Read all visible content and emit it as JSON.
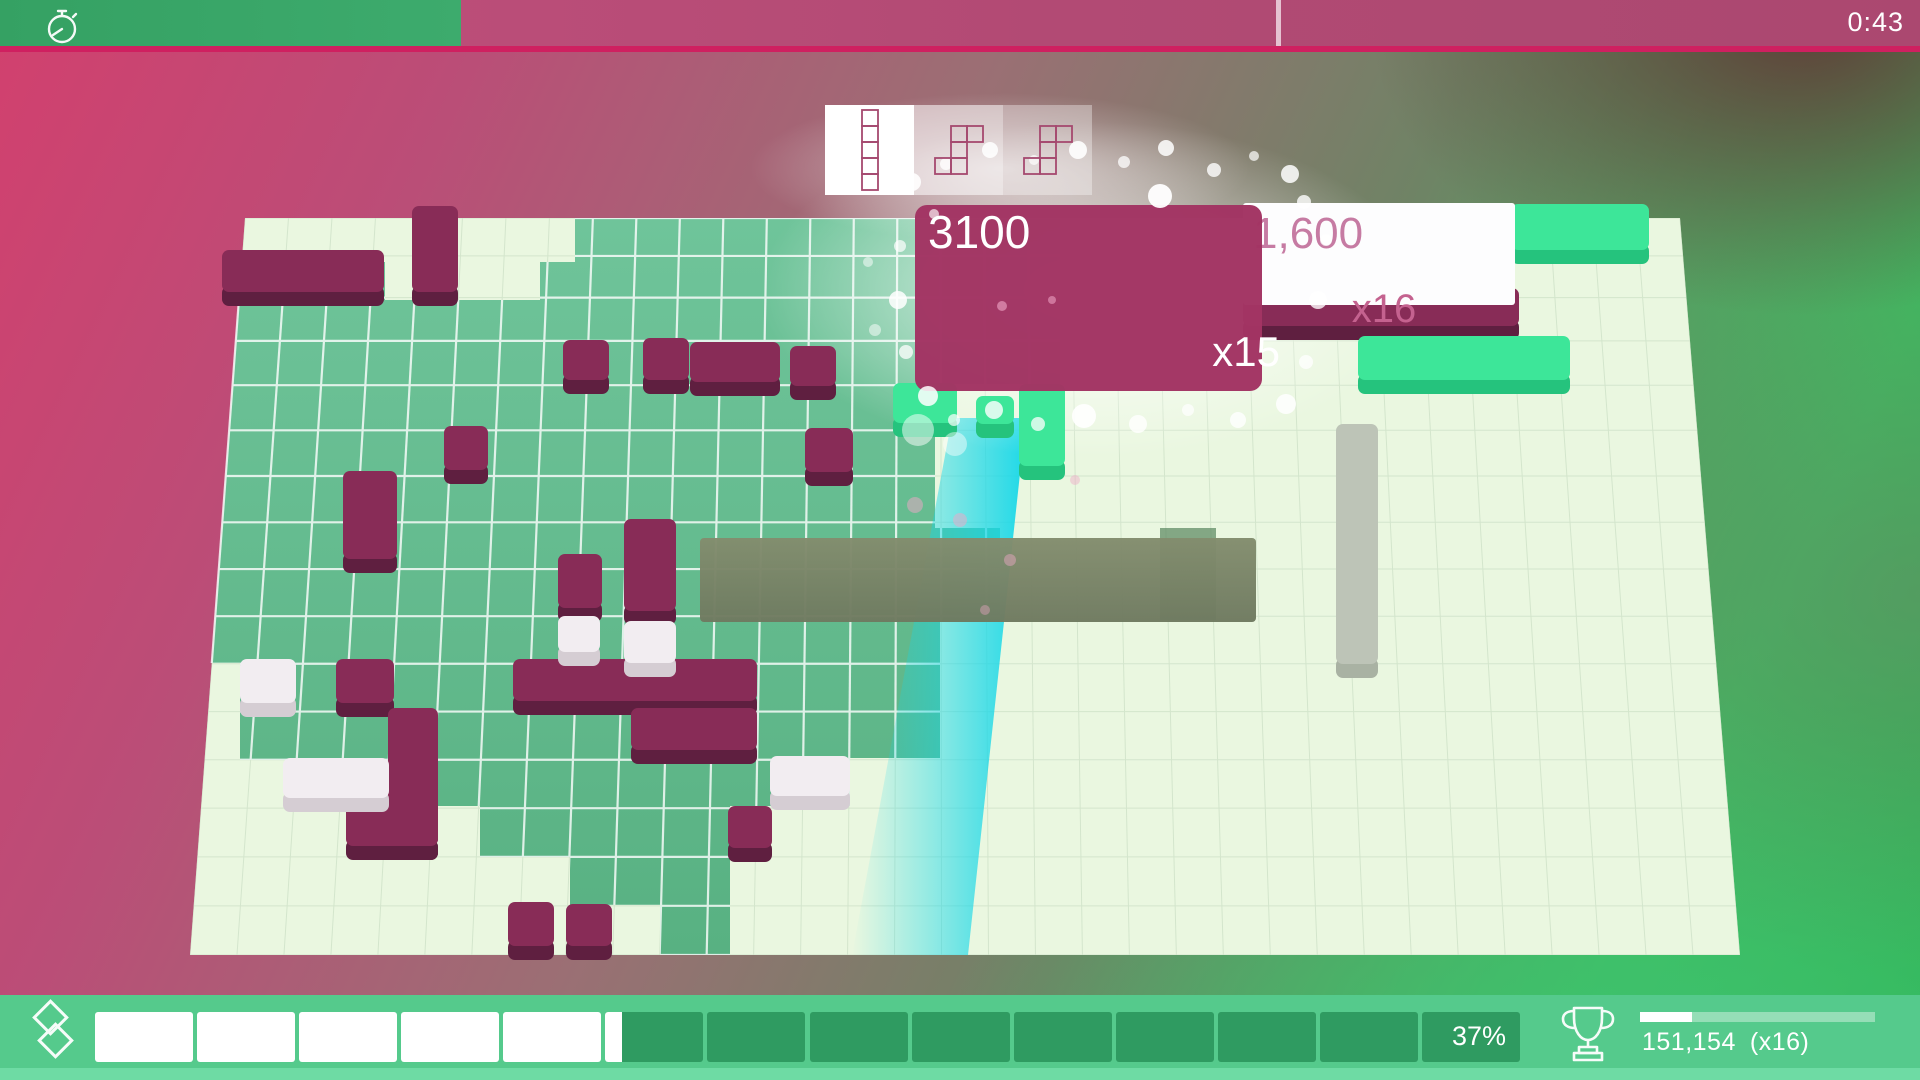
{
  "hud": {
    "timer": {
      "value": "0:43",
      "fill_ratio": 0.24,
      "divider_x": 1276,
      "icon": "stopwatch-icon"
    },
    "pieces": {
      "stroke": "#a5496f",
      "queue": [
        {
          "name": "piece-i5",
          "cells": [
            [
              0,
              0
            ],
            [
              0,
              1
            ],
            [
              0,
              2
            ],
            [
              0,
              3
            ],
            [
              0,
              4
            ]
          ],
          "box_opacity": 1
        },
        {
          "name": "piece-s5",
          "cells": [
            [
              1,
              0
            ],
            [
              2,
              0
            ],
            [
              1,
              1
            ],
            [
              0,
              2
            ],
            [
              1,
              2
            ]
          ],
          "box_opacity": 0.55
        },
        {
          "name": "piece-s5",
          "cells": [
            [
              1,
              0
            ],
            [
              2,
              0
            ],
            [
              1,
              1
            ],
            [
              0,
              2
            ],
            [
              1,
              2
            ]
          ],
          "box_opacity": 0.35
        }
      ]
    },
    "bottom": {
      "percent": "37%",
      "ratio": 0.37,
      "segments": 14,
      "score": "151,154",
      "score_multiplier": "(x16)",
      "mini_bar_ratio": 0.22,
      "icon_left": "blocks-icon",
      "icon_trophy": "trophy-icon"
    }
  },
  "score_popups": [
    {
      "points": "3100",
      "multiplier": "x15",
      "style": "magenta",
      "rect": {
        "x": 915,
        "y": 205,
        "w": 347,
        "h": 186
      }
    },
    {
      "points": "1,600",
      "multiplier": "x16",
      "style": "white",
      "rect": {
        "x": 1243,
        "y": 203,
        "w": 272,
        "h": 102
      }
    }
  ],
  "board": {
    "quad": {
      "tl": [
        245,
        218
      ],
      "tr": [
        1680,
        218
      ],
      "br": [
        1740,
        955
      ],
      "bl": [
        190,
        955
      ]
    },
    "cols": 33,
    "rows": 16,
    "colors": {
      "base": "#eaf7e0",
      "grid_faint": "#c2d8bd",
      "grid_white": "#ffffff",
      "green_top": "#6fc49a",
      "green_bottom": "#58b182",
      "olive": "#7b8567",
      "cyan": "#14d7e8",
      "sage_patch": "#57855c",
      "m_top": "#882c57",
      "m_front": "#5f1f40",
      "w_top": "#f2edf1",
      "w_front": "#d5cdd3",
      "g_top": "#3de699",
      "g_front": "#25c37d",
      "s_top": "#bdc4b7",
      "s_front": "#a9b2a3",
      "popup_magenta": "#a23463",
      "popup_white": "#fdfdfe",
      "popup_pink_text": "#c67ba3",
      "mult_pink_text": "#c4628f"
    },
    "green_region": "232,262 385,262 385,300 540,300 540,262 575,262 575,218 1060,218 1060,385 935,385 935,528 1000,528 1000,622 940,622 940,758 850,758 850,806 730,806 730,955 660,955 660,905 570,905 570,857 480,857 480,806 385,806 385,760 240,760 240,663 205,663",
    "cyan_column": "952,418 1026,418 968,955 852,955",
    "olive_bar": {
      "x": 700,
      "y": 538,
      "w": 556,
      "h": 84
    },
    "sage_patch": {
      "x": 1160,
      "y": 528,
      "w": 56,
      "h": 92
    },
    "blocks": [
      {
        "x": 222,
        "y": 250,
        "w": 162,
        "h": 42,
        "c": "m"
      },
      {
        "x": 412,
        "y": 206,
        "w": 46,
        "h": 86,
        "c": "m"
      },
      {
        "x": 563,
        "y": 340,
        "w": 46,
        "h": 40,
        "c": "m"
      },
      {
        "x": 643,
        "y": 338,
        "w": 46,
        "h": 42,
        "c": "m"
      },
      {
        "x": 690,
        "y": 342,
        "w": 90,
        "h": 40,
        "c": "m"
      },
      {
        "x": 790,
        "y": 346,
        "w": 46,
        "h": 40,
        "c": "m"
      },
      {
        "x": 805,
        "y": 428,
        "w": 48,
        "h": 44,
        "c": "m"
      },
      {
        "x": 444,
        "y": 426,
        "w": 44,
        "h": 44,
        "c": "m"
      },
      {
        "x": 343,
        "y": 471,
        "w": 54,
        "h": 88,
        "c": "m"
      },
      {
        "x": 336,
        "y": 659,
        "w": 58,
        "h": 44,
        "c": "m"
      },
      {
        "x": 388,
        "y": 708,
        "w": 50,
        "h": 138,
        "c": "m"
      },
      {
        "x": 346,
        "y": 804,
        "w": 92,
        "h": 42,
        "c": "m"
      },
      {
        "x": 508,
        "y": 902,
        "w": 46,
        "h": 44,
        "c": "m"
      },
      {
        "x": 558,
        "y": 554,
        "w": 44,
        "h": 54,
        "c": "m"
      },
      {
        "x": 624,
        "y": 519,
        "w": 52,
        "h": 92,
        "c": "m"
      },
      {
        "x": 513,
        "y": 659,
        "w": 244,
        "h": 42,
        "c": "m"
      },
      {
        "x": 631,
        "y": 708,
        "w": 126,
        "h": 42,
        "c": "m"
      },
      {
        "x": 728,
        "y": 806,
        "w": 44,
        "h": 42,
        "c": "m"
      },
      {
        "x": 566,
        "y": 904,
        "w": 46,
        "h": 42,
        "c": "m"
      },
      {
        "x": 1243,
        "y": 288,
        "w": 276,
        "h": 38,
        "c": "m"
      },
      {
        "x": 240,
        "y": 659,
        "w": 56,
        "h": 44,
        "c": "w"
      },
      {
        "x": 283,
        "y": 758,
        "w": 106,
        "h": 40,
        "c": "w"
      },
      {
        "x": 558,
        "y": 616,
        "w": 42,
        "h": 36,
        "c": "w"
      },
      {
        "x": 624,
        "y": 621,
        "w": 52,
        "h": 42,
        "c": "w"
      },
      {
        "x": 770,
        "y": 756,
        "w": 80,
        "h": 40,
        "c": "w"
      },
      {
        "x": 893,
        "y": 383,
        "w": 64,
        "h": 40,
        "c": "g"
      },
      {
        "x": 976,
        "y": 396,
        "w": 38,
        "h": 28,
        "c": "g"
      },
      {
        "x": 1019,
        "y": 384,
        "w": 46,
        "h": 82,
        "c": "g"
      },
      {
        "x": 1358,
        "y": 336,
        "w": 212,
        "h": 44,
        "c": "g"
      },
      {
        "x": 1511,
        "y": 204,
        "w": 138,
        "h": 46,
        "c": "g"
      },
      {
        "x": 1336,
        "y": 424,
        "w": 42,
        "h": 240,
        "c": "s"
      }
    ],
    "particles": [
      {
        "x": 912,
        "y": 182,
        "r": 9,
        "o": 0.9,
        "c": "w"
      },
      {
        "x": 946,
        "y": 164,
        "r": 6,
        "o": 0.8,
        "c": "w"
      },
      {
        "x": 990,
        "y": 150,
        "r": 8,
        "o": 0.85,
        "c": "w"
      },
      {
        "x": 1034,
        "y": 160,
        "r": 5,
        "o": 0.7,
        "c": "w"
      },
      {
        "x": 1078,
        "y": 150,
        "r": 9,
        "o": 0.9,
        "c": "w"
      },
      {
        "x": 1124,
        "y": 162,
        "r": 6,
        "o": 0.75,
        "c": "w"
      },
      {
        "x": 1166,
        "y": 148,
        "r": 8,
        "o": 0.85,
        "c": "w"
      },
      {
        "x": 1214,
        "y": 170,
        "r": 7,
        "o": 0.8,
        "c": "w"
      },
      {
        "x": 1254,
        "y": 156,
        "r": 5,
        "o": 0.7,
        "c": "w"
      },
      {
        "x": 1290,
        "y": 174,
        "r": 9,
        "o": 0.85,
        "c": "w"
      },
      {
        "x": 1160,
        "y": 196,
        "r": 12,
        "o": 0.95,
        "c": "w"
      },
      {
        "x": 1304,
        "y": 202,
        "r": 7,
        "o": 0.8,
        "c": "w"
      },
      {
        "x": 1326,
        "y": 240,
        "r": 6,
        "o": 0.7,
        "c": "w"
      },
      {
        "x": 1318,
        "y": 300,
        "r": 9,
        "o": 0.8,
        "c": "w"
      },
      {
        "x": 1306,
        "y": 362,
        "r": 7,
        "o": 0.75,
        "c": "w"
      },
      {
        "x": 1286,
        "y": 404,
        "r": 10,
        "o": 0.85,
        "c": "w"
      },
      {
        "x": 1238,
        "y": 420,
        "r": 8,
        "o": 0.8,
        "c": "w"
      },
      {
        "x": 1188,
        "y": 410,
        "r": 6,
        "o": 0.7,
        "c": "w"
      },
      {
        "x": 1138,
        "y": 424,
        "r": 9,
        "o": 0.8,
        "c": "w"
      },
      {
        "x": 1084,
        "y": 416,
        "r": 12,
        "o": 0.9,
        "c": "w"
      },
      {
        "x": 1038,
        "y": 424,
        "r": 7,
        "o": 0.75,
        "c": "w"
      },
      {
        "x": 994,
        "y": 410,
        "r": 9,
        "o": 0.8,
        "c": "w"
      },
      {
        "x": 954,
        "y": 420,
        "r": 6,
        "o": 0.7,
        "c": "w"
      },
      {
        "x": 928,
        "y": 396,
        "r": 10,
        "o": 0.85,
        "c": "w"
      },
      {
        "x": 906,
        "y": 352,
        "r": 7,
        "o": 0.75,
        "c": "w"
      },
      {
        "x": 898,
        "y": 300,
        "r": 9,
        "o": 0.85,
        "c": "w"
      },
      {
        "x": 900,
        "y": 246,
        "r": 6,
        "o": 0.7,
        "c": "w"
      },
      {
        "x": 934,
        "y": 214,
        "r": 5,
        "o": 0.65,
        "c": "w"
      },
      {
        "x": 918,
        "y": 430,
        "r": 16,
        "o": 0.5,
        "c": "w"
      },
      {
        "x": 955,
        "y": 444,
        "r": 12,
        "o": 0.45,
        "c": "w"
      },
      {
        "x": 868,
        "y": 262,
        "r": 5,
        "o": 0.5,
        "c": "w"
      },
      {
        "x": 875,
        "y": 330,
        "r": 6,
        "o": 0.5,
        "c": "w"
      },
      {
        "x": 1002,
        "y": 306,
        "r": 5,
        "o": 0.6,
        "c": "p"
      },
      {
        "x": 1052,
        "y": 300,
        "r": 4,
        "o": 0.55,
        "c": "p"
      },
      {
        "x": 960,
        "y": 520,
        "r": 7,
        "o": 0.5,
        "c": "p"
      },
      {
        "x": 1010,
        "y": 560,
        "r": 6,
        "o": 0.45,
        "c": "p"
      },
      {
        "x": 915,
        "y": 505,
        "r": 8,
        "o": 0.5,
        "c": "p"
      },
      {
        "x": 985,
        "y": 610,
        "r": 5,
        "o": 0.4,
        "c": "p"
      },
      {
        "x": 1075,
        "y": 480,
        "r": 5,
        "o": 0.45,
        "c": "p"
      }
    ]
  }
}
